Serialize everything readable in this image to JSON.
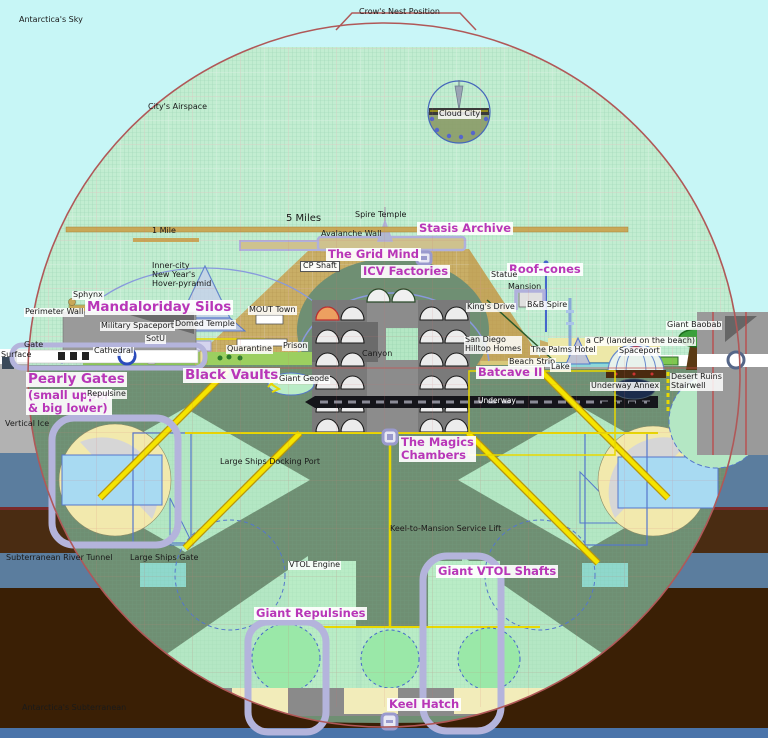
{
  "diagram": {
    "subject": "Giant spherical city-ship cross-section",
    "colors": {
      "sky": "#c7f6f6",
      "airspace_grid": "#c2edd1",
      "underground_sage": "#6f8f73",
      "interior_light_green": "#b4e7c4",
      "mound_tan": "#c9ae66",
      "city_green": "#8cc84e",
      "accent_magenta": "#b836b8",
      "hull_red": "#b05858",
      "shaft_yellow": "#f0e000",
      "purple_outline": "#b4b4dc",
      "earth_brown": "#3a1f05",
      "strata_blue": "#5b7d9e",
      "ice_gray": "#b2b2b2",
      "water_teal": "#8fd8d8",
      "keel_cream": "#f2ecba",
      "underway_black": "#15151a",
      "bottom_strip_blue": "#4a74aa"
    }
  },
  "labels": [
    {
      "name": "antarcticas-sky",
      "text": "Antarctica's Sky",
      "x": 19,
      "y": 16,
      "cls": "s"
    },
    {
      "name": "crows-nest-position",
      "text": "Crow's Nest Position",
      "x": 359,
      "y": 8,
      "cls": "s"
    },
    {
      "name": "citys-airspace",
      "text": "City's Airspace",
      "x": 148,
      "y": 103,
      "cls": "s"
    },
    {
      "name": "cloud-city",
      "text": "Cloud City",
      "x": 438,
      "y": 110,
      "cls": "sb"
    },
    {
      "name": "five-miles",
      "text": "5 Miles",
      "x": 286,
      "y": 213,
      "cls": "s2"
    },
    {
      "name": "one-mile",
      "text": "1 Mile",
      "x": 152,
      "y": 227,
      "cls": "s"
    },
    {
      "name": "spire-temple",
      "text": "Spire Temple",
      "x": 355,
      "y": 211,
      "cls": "s"
    },
    {
      "name": "avalanche-wall",
      "text": "Avalanche Wall",
      "x": 321,
      "y": 230,
      "cls": "s"
    },
    {
      "name": "stasis-archive",
      "text": "Stasis Archive",
      "x": 417,
      "y": 222,
      "cls": "m"
    },
    {
      "name": "the-grid-mind",
      "text": "The Grid Mind",
      "x": 326,
      "y": 248,
      "cls": "m"
    },
    {
      "name": "icv-factories",
      "text": "ICV Factories",
      "x": 361,
      "y": 265,
      "cls": "m"
    },
    {
      "name": "cp-shaft",
      "text": "CP Shaft",
      "x": 300,
      "y": 261,
      "cls": "sbx"
    },
    {
      "name": "roof-cones",
      "text": "Roof-cones",
      "x": 507,
      "y": 263,
      "cls": "m"
    },
    {
      "name": "statue",
      "text": "Statue",
      "x": 490,
      "y": 271,
      "cls": "sb"
    },
    {
      "name": "mansion",
      "text": "Mansion",
      "x": 508,
      "y": 283,
      "cls": "s"
    },
    {
      "name": "bb-spire",
      "text": "B&B Spire",
      "x": 526,
      "y": 301,
      "cls": "sb"
    },
    {
      "name": "kings-drive",
      "text": "King's Drive",
      "x": 466,
      "y": 303,
      "cls": "sb"
    },
    {
      "name": "inner-city-hover-pyramid",
      "text": "Inner-city\nNew Year's\nHover-pyramid",
      "x": 152,
      "y": 262,
      "cls": "s"
    },
    {
      "name": "sphynx",
      "text": "Sphynx",
      "x": 72,
      "y": 291,
      "cls": "sb"
    },
    {
      "name": "mandaloriday-silos",
      "text": "Mandaloriday Silos",
      "x": 85,
      "y": 300,
      "cls": "ml"
    },
    {
      "name": "military-spaceport",
      "text": "Military Spaceport",
      "x": 100,
      "y": 322,
      "cls": "sb"
    },
    {
      "name": "perimeter-wall",
      "text": "Perimeter Wall",
      "x": 24,
      "y": 308,
      "cls": "sb"
    },
    {
      "name": "mout-town",
      "text": "MOUT Town",
      "x": 248,
      "y": 306,
      "cls": "sb"
    },
    {
      "name": "cathedral",
      "text": "Cathedral",
      "x": 93,
      "y": 347,
      "cls": "sb"
    },
    {
      "name": "sotu",
      "text": "SotU",
      "x": 145,
      "y": 335,
      "cls": "sb"
    },
    {
      "name": "domed-temple",
      "text": "Domed Temple",
      "x": 174,
      "y": 320,
      "cls": "sb"
    },
    {
      "name": "quarantine",
      "text": "Quarantine",
      "x": 226,
      "y": 345,
      "cls": "sb"
    },
    {
      "name": "prison",
      "text": "Prison",
      "x": 282,
      "y": 342,
      "cls": "sb"
    },
    {
      "name": "san-diego-hilltop-homes",
      "text": "San Diego\nHilltop Homes",
      "x": 464,
      "y": 336,
      "cls": "sb"
    },
    {
      "name": "the-palms-hotel",
      "text": "The Palms Hotel",
      "x": 530,
      "y": 346,
      "cls": "sb"
    },
    {
      "name": "beach-strip",
      "text": "Beach Strip",
      "x": 508,
      "y": 358,
      "cls": "sb"
    },
    {
      "name": "lake",
      "text": "Lake",
      "x": 550,
      "y": 363,
      "cls": "sb"
    },
    {
      "name": "cp-landed-on-beach",
      "text": "a CP (landed on the beach)",
      "x": 585,
      "y": 337,
      "cls": "sb"
    },
    {
      "name": "giant-baobab",
      "text": "Giant Baobab",
      "x": 666,
      "y": 321,
      "cls": "sb"
    },
    {
      "name": "spaceport",
      "text": "Spaceport",
      "x": 618,
      "y": 347,
      "cls": "sb"
    },
    {
      "name": "desert-ruins-stairwell",
      "text": "Desert Ruins\nStairwell",
      "x": 670,
      "y": 373,
      "cls": "sb"
    },
    {
      "name": "underway-annex",
      "text": "Underway Annex",
      "x": 590,
      "y": 382,
      "cls": "sb"
    },
    {
      "name": "batcave-ii",
      "text": "Batcave II",
      "x": 476,
      "y": 366,
      "cls": "m"
    },
    {
      "name": "underway",
      "text": "Underway",
      "x": 478,
      "y": 397,
      "cls": "w"
    },
    {
      "name": "pearly-gates",
      "text": "Pearly Gates",
      "x": 26,
      "y": 372,
      "cls": "ml"
    },
    {
      "name": "pearly-gates-sub",
      "text": "(small upper\n& big lower)",
      "x": 26,
      "y": 389,
      "cls": "m"
    },
    {
      "name": "repulsine",
      "text": "Repulsine",
      "x": 86,
      "y": 390,
      "cls": "sb"
    },
    {
      "name": "black-vaults",
      "text": "Black Vaults",
      "x": 183,
      "y": 368,
      "cls": "ml"
    },
    {
      "name": "giant-geode",
      "text": "Giant Geode",
      "x": 278,
      "y": 375,
      "cls": "sb"
    },
    {
      "name": "canyon",
      "text": "Canyon",
      "x": 362,
      "y": 350,
      "cls": "s"
    },
    {
      "name": "vertical-ice",
      "text": "Vertical Ice",
      "x": 5,
      "y": 420,
      "cls": "s"
    },
    {
      "name": "the-magics-chambers",
      "text": "The Magics\nChambers",
      "x": 399,
      "y": 436,
      "cls": "m"
    },
    {
      "name": "large-ships-docking-port",
      "text": "Large Ships Docking Port",
      "x": 220,
      "y": 458,
      "cls": "s"
    },
    {
      "name": "keel-to-mansion-service-lift",
      "text": "Keel-to-Mansion Service Lift",
      "x": 390,
      "y": 525,
      "cls": "s"
    },
    {
      "name": "subterranean-river-tunnel",
      "text": "Subterranean River Tunnel",
      "x": 6,
      "y": 554,
      "cls": "s"
    },
    {
      "name": "large-ships-gate",
      "text": "Large Ships Gate",
      "x": 130,
      "y": 554,
      "cls": "s"
    },
    {
      "name": "vtol-engine",
      "text": "VTOL Engine",
      "x": 288,
      "y": 561,
      "cls": "sb"
    },
    {
      "name": "giant-vtol-shafts",
      "text": "Giant VTOL Shafts",
      "x": 436,
      "y": 565,
      "cls": "m"
    },
    {
      "name": "giant-repulsines",
      "text": "Giant Repulsines",
      "x": 254,
      "y": 607,
      "cls": "m"
    },
    {
      "name": "keel-hatch",
      "text": "Keel Hatch",
      "x": 387,
      "y": 698,
      "cls": "m"
    },
    {
      "name": "antarcticas-subterranean",
      "text": "Antarctica's Subterranean",
      "x": 22,
      "y": 704,
      "cls": "s"
    },
    {
      "name": "surface",
      "text": "Surface",
      "x": 1,
      "y": 351,
      "cls": "s"
    },
    {
      "name": "gate",
      "text": "Gate",
      "x": 24,
      "y": 341,
      "cls": "s"
    }
  ]
}
